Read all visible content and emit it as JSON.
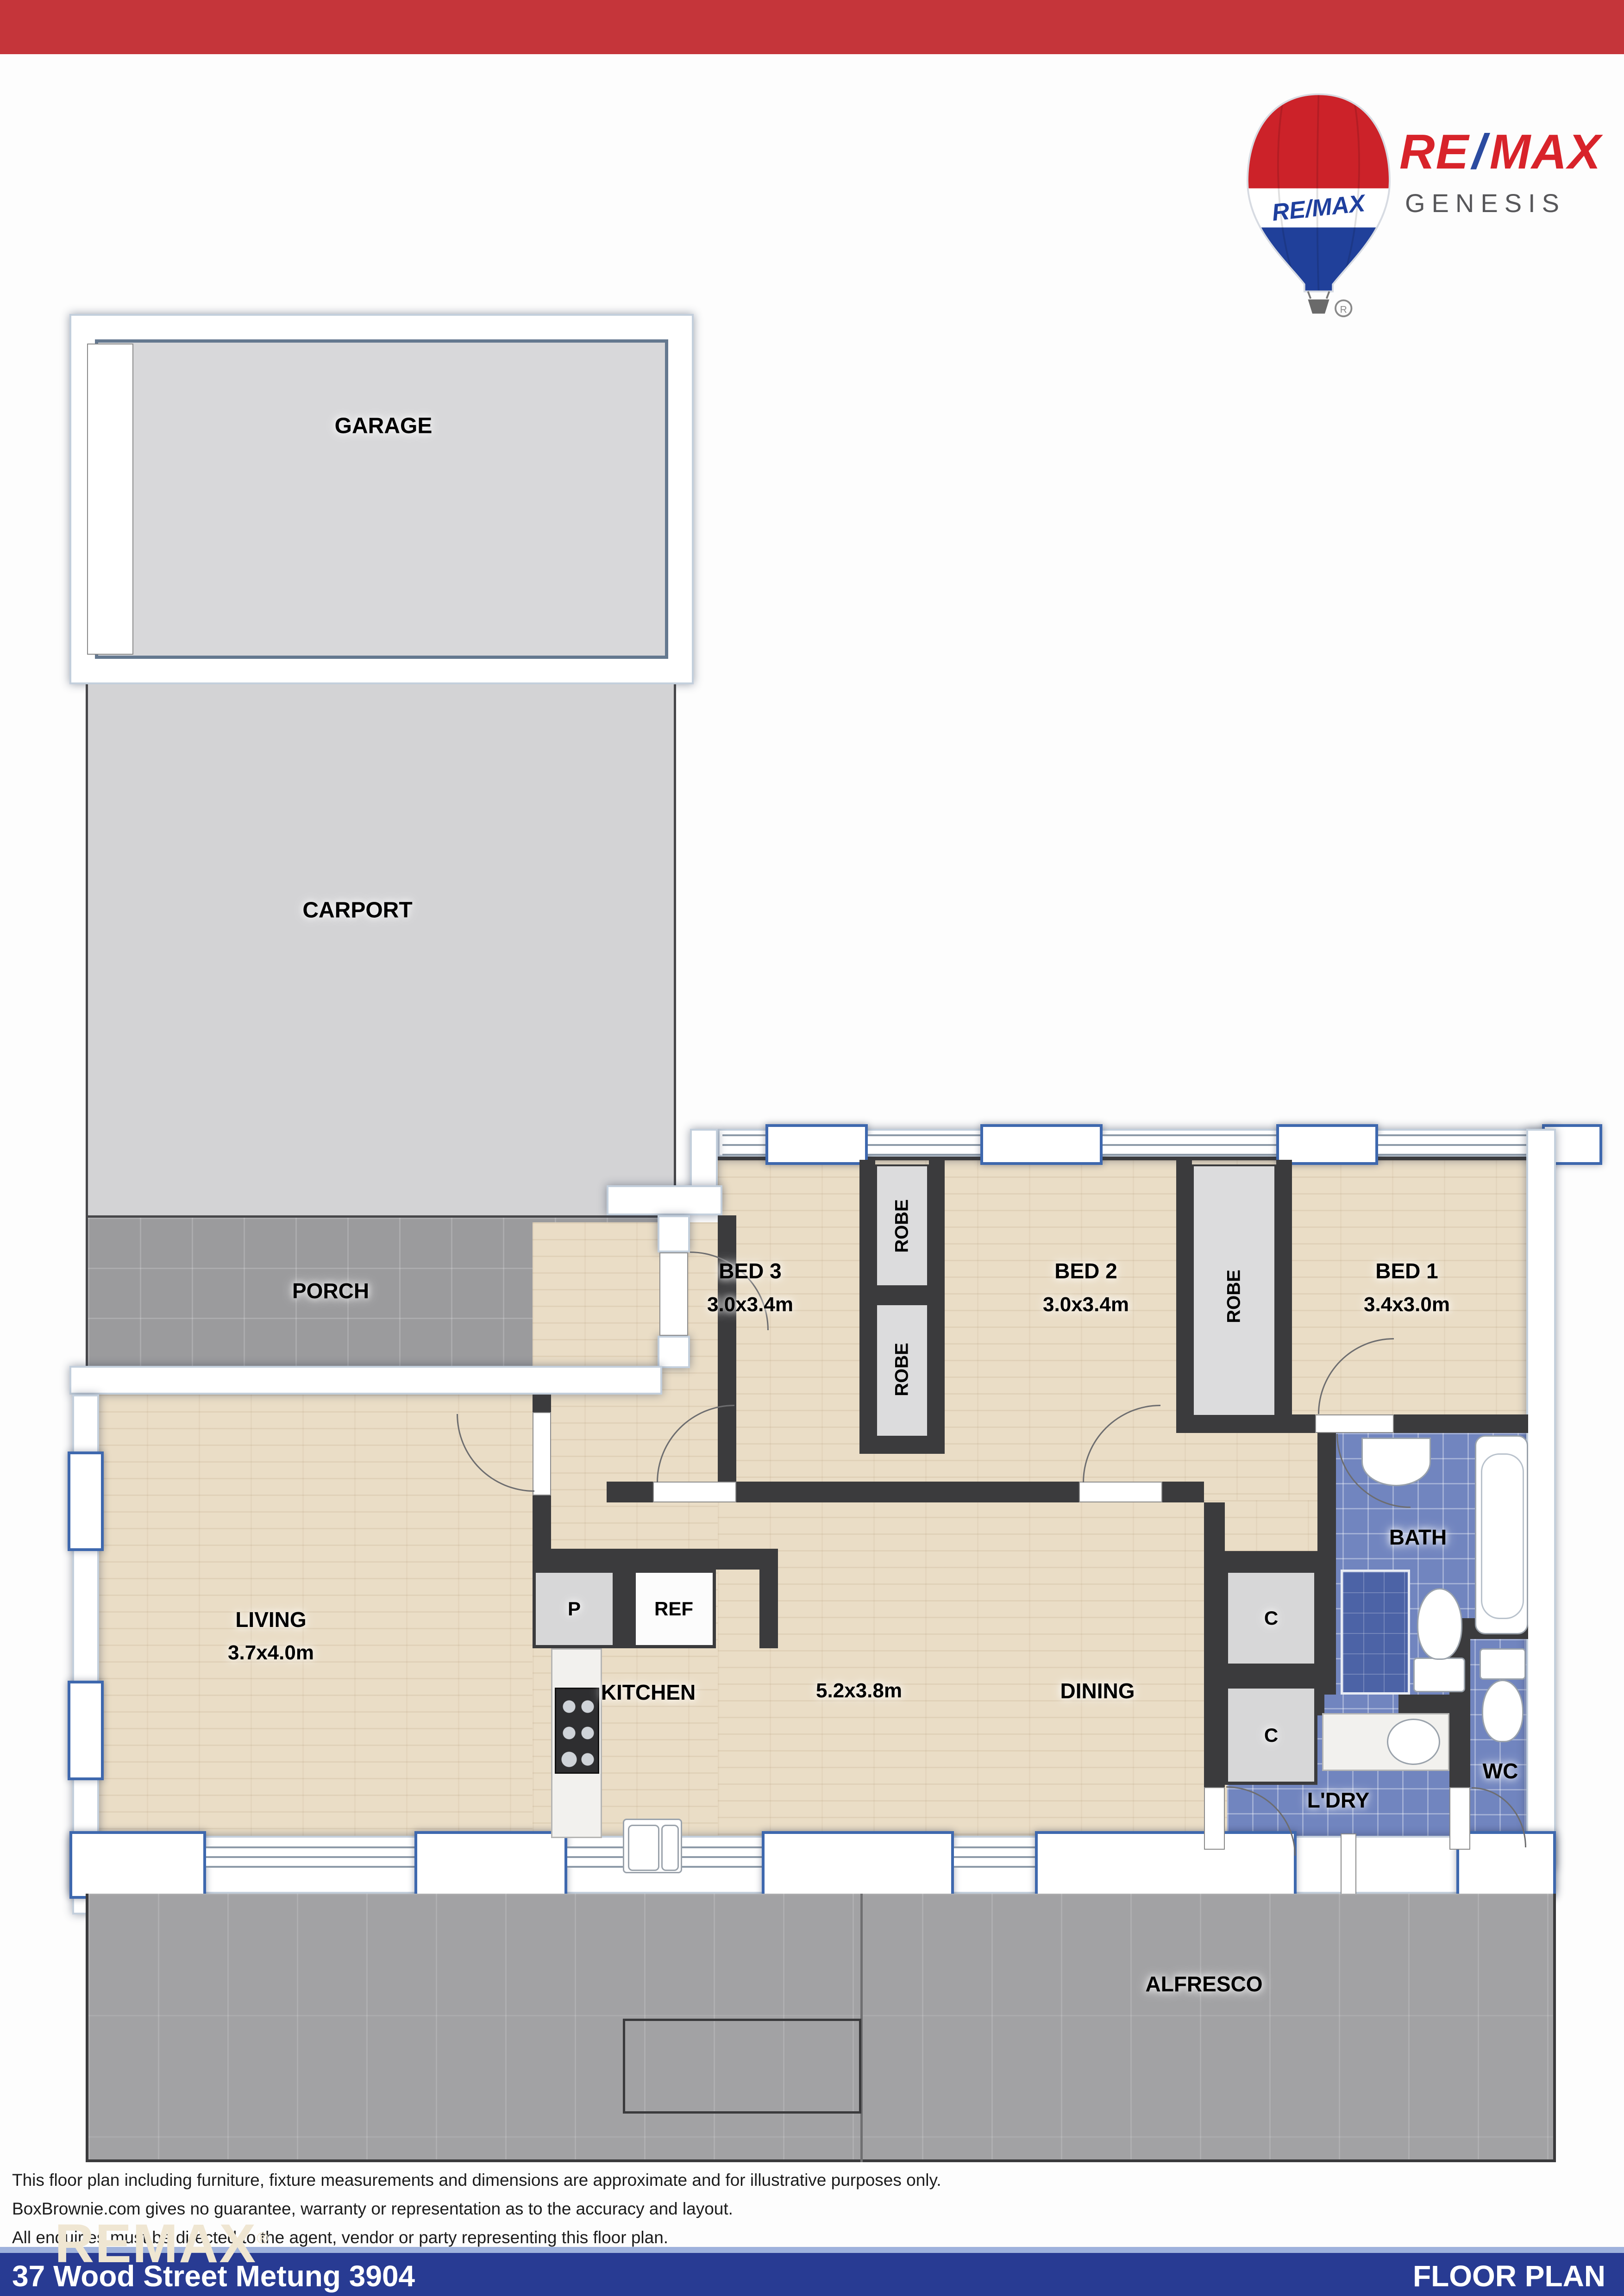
{
  "logo": {
    "balloon_label": "RE/MAX",
    "name_re": "RE",
    "name_slash": "/",
    "name_max": "MAX",
    "division": "GENESIS",
    "registered": "®"
  },
  "colors": {
    "top_bar": "#c5353a",
    "footer_bar": "#283b93",
    "remax_red": "#d8232a",
    "remax_blue": "#2b4ba0",
    "wall_dark": "#3b3b3d",
    "tile_blue": "#7185bf",
    "wood": "#eaddc6"
  },
  "plan": {
    "garage": {
      "label": "GARAGE"
    },
    "carport": {
      "label": "CARPORT"
    },
    "porch": {
      "label": "PORCH"
    },
    "bed3": {
      "label": "BED 3",
      "dims": "3.0x3.4m"
    },
    "bed2": {
      "label": "BED 2",
      "dims": "3.0x3.4m"
    },
    "bed1": {
      "label": "BED 1",
      "dims": "3.4x3.0m"
    },
    "robe": {
      "label": "ROBE"
    },
    "living": {
      "label": "LIVING",
      "dims": "3.7x4.0m"
    },
    "kitchen": {
      "label": "KITCHEN"
    },
    "open_plan": {
      "dims": "5.2x3.8m"
    },
    "dining": {
      "label": "DINING"
    },
    "pantry": {
      "label": "P"
    },
    "fridge": {
      "label": "REF"
    },
    "cupboard": {
      "label": "C"
    },
    "bath": {
      "label": "BATH"
    },
    "laundry": {
      "label": "L'DRY"
    },
    "wc": {
      "label": "WC"
    },
    "alfresco": {
      "label": "ALFRESCO"
    }
  },
  "footer": {
    "disclaimer": [
      "This floor plan including furniture, fixture measurements and dimensions are approximate and for illustrative purposes only.",
      "BoxBrownie.com gives no guarantee, warranty or representation as to the accuracy and layout.",
      "All enquiries must be directed to the agent, vendor or party representing this floor plan."
    ],
    "watermark": "REMAX",
    "address": "37 Wood Street Metung 3904",
    "doc_title": "FLOOR PLAN"
  }
}
